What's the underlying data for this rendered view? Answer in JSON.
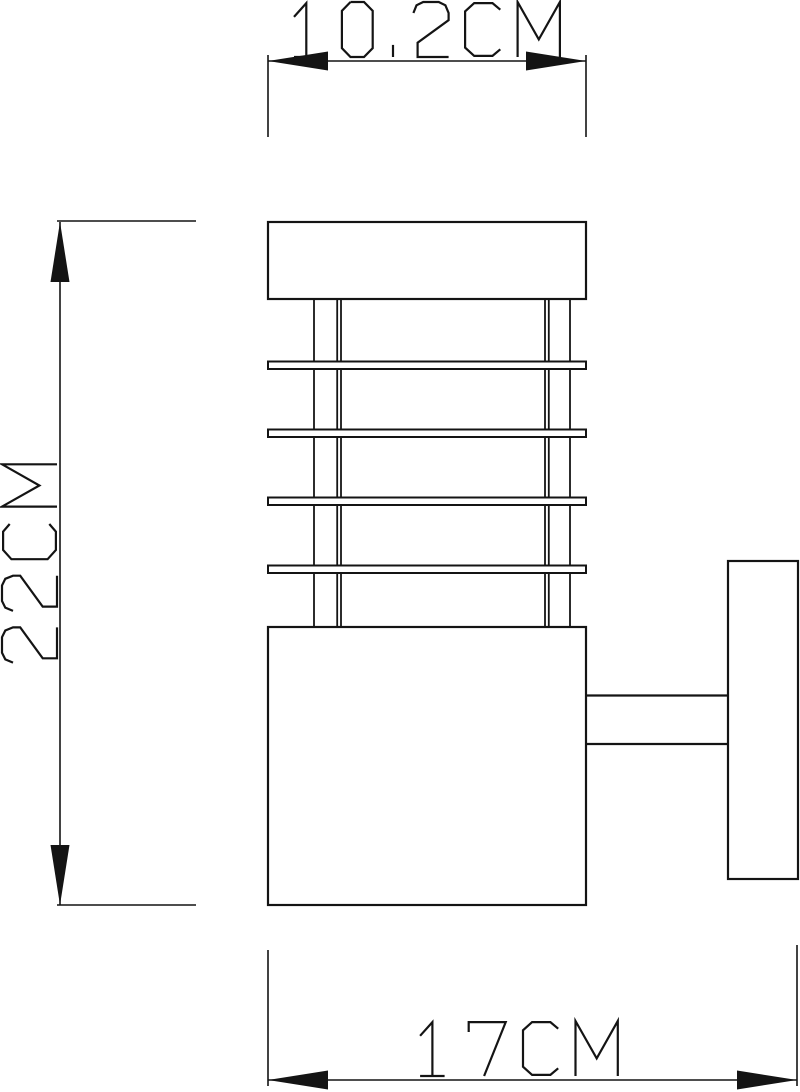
{
  "canvas": {
    "background": "#ffffff",
    "line_color": "#141414",
    "width_px": 800,
    "height_px": 1092
  },
  "drawing": {
    "kind": "technical dimension drawing",
    "dimensions": {
      "top": {
        "label": "10.2CM",
        "value_cm": 10.2,
        "orientation": "horizontal"
      },
      "left": {
        "label": "22CM",
        "value_cm": 22,
        "orientation": "vertical"
      },
      "bottom": {
        "label": "17CM",
        "value_cm": 17,
        "orientation": "horizontal"
      }
    }
  }
}
